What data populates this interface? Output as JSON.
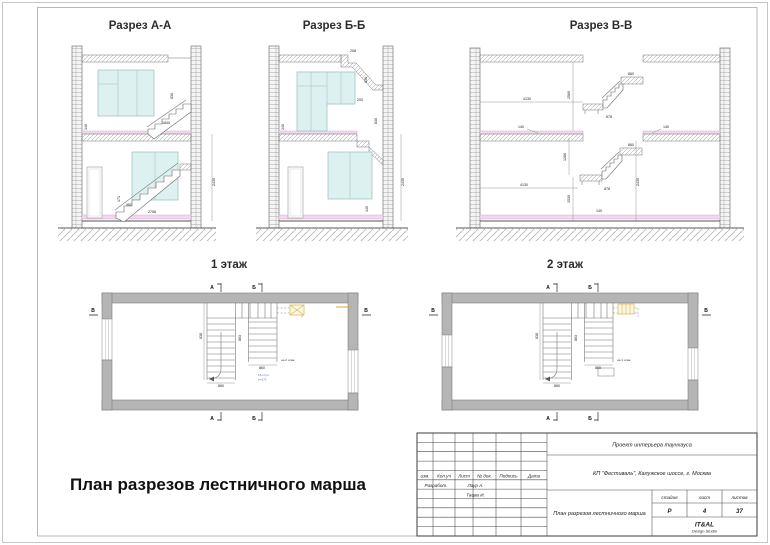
{
  "titles": {
    "section_a": "Разрез А-А",
    "section_b": "Разрез Б-Б",
    "section_v": "Разрез В-В",
    "floor1": "1 этаж",
    "floor2": "2 этаж",
    "footer": "План разрезов лестничного марша"
  },
  "dims": {
    "a": {
      "d1": "836",
      "d2": "1840",
      "d3": "960",
      "d4": "171",
      "d5": "2758",
      "d6": "140",
      "d7": "2430"
    },
    "b": {
      "d1": "208",
      "d2": "830",
      "d3": "200",
      "d4": "830",
      "d5": "2430",
      "d6": "140",
      "d7": "140"
    },
    "v": {
      "w_top": "4130",
      "w_bot": "4130",
      "h_top": "2560",
      "mid": "1286",
      "low": "1530",
      "right": "2430",
      "land_t": "860",
      "fl_t": "878",
      "land_b": "860",
      "fl_b": "878",
      "s1": "140",
      "s2": "140",
      "s3": "140"
    }
  },
  "plan1": {
    "dv1": "838",
    "dv2": "863",
    "df1": "860",
    "df2": "860",
    "note": "на 2 этаж",
    "blue1": "15 ступ.",
    "blue2": "h=171"
  },
  "plan2": {
    "dv1": "838",
    "dv2": "863",
    "df1": "860",
    "df2": "860",
    "note": "на 1 этаж"
  },
  "markers": {
    "a": "А",
    "b": "Б",
    "v": "В"
  },
  "titleblock": {
    "project": "Проект интерьера таунхауса",
    "address": "КП \"Фестиваль\", Калужское шоссе, г. Москва",
    "doc_title": "План разрезов лестничного марша",
    "col_izm": "изм.",
    "col_koluch": "Кол.уч",
    "col_list": "Лист",
    "col_ndok": "№ док.",
    "col_podpis": "Подпись",
    "col_data": "Дата",
    "row_razrabot": "Разработ.",
    "name1": "Лаур А.",
    "name2": "Тацва И.",
    "stage_label": "стадия",
    "sheet_label": "лист",
    "sheets_label": "листов",
    "stage": "Р",
    "sheet": "4",
    "sheets": "37",
    "studio": "IT&AL",
    "studio_sub": "Design Studio"
  }
}
